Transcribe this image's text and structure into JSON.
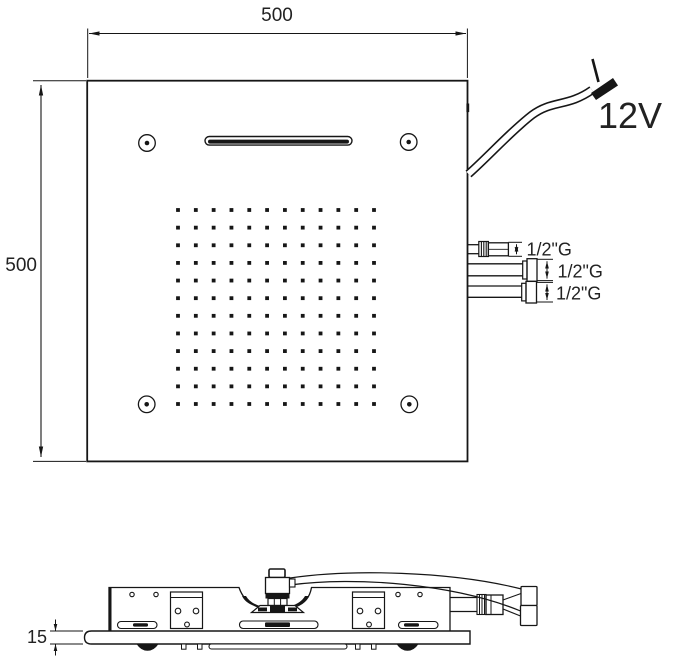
{
  "drawing": {
    "type": "technical-drawing",
    "subject": "ceiling shower head, top view and side view"
  },
  "labels": {
    "top_width": "500",
    "left_height": "500",
    "power": "12V",
    "thickness": "15"
  },
  "connections": [
    {
      "label": "1/2\"G"
    },
    {
      "label": "1/2\"G"
    },
    {
      "label": "1/2\"G"
    }
  ],
  "top_view": {
    "nozzle_grid": {
      "rows": 12,
      "cols": 12
    },
    "screw_holes": 4,
    "waterfall_slot": 1
  },
  "side_view": {
    "thickness_value": "15"
  },
  "colors": {
    "line": "#161616",
    "text": "#222222",
    "background": "#ffffff"
  }
}
